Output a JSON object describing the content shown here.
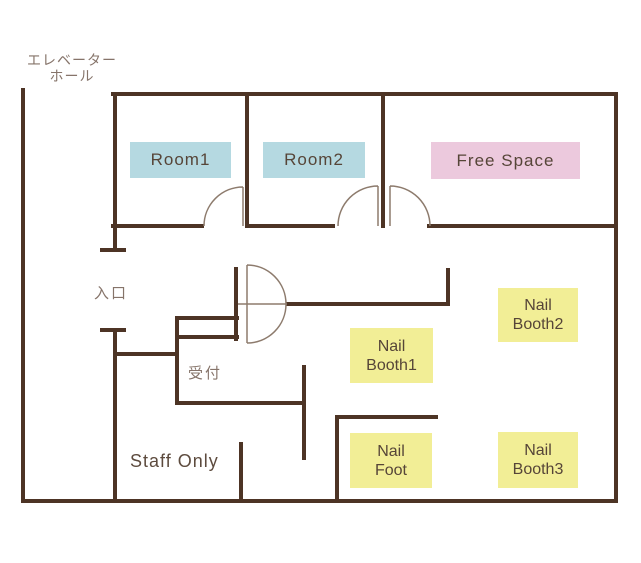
{
  "colors": {
    "wall": "#4d3425",
    "door_line": "#8d7b6d",
    "room_fill": "#b5d9e1",
    "free_space_fill": "#ecc9dd",
    "booth_fill": "#f2ee96",
    "jp_label_text": "#86746a",
    "box_text": "#564538",
    "dark_label_text": "#5d4b3e",
    "background": "#ffffff"
  },
  "plan": {
    "elevator_hall_line1": "エレベーター",
    "elevator_hall_line2": "ホール",
    "entrance": "入口",
    "reception": "受付",
    "staff_only": "Staff Only"
  },
  "rooms": {
    "room1": {
      "label": "Room1"
    },
    "room2": {
      "label": "Room2"
    },
    "free_space": {
      "label": "Free Space"
    },
    "nail_booth1": {
      "line1": "Nail",
      "line2": "Booth1"
    },
    "nail_booth2": {
      "line1": "Nail",
      "line2": "Booth2"
    },
    "nail_foot": {
      "line1": "Nail",
      "line2": "Foot"
    },
    "nail_booth3": {
      "line1": "Nail",
      "line2": "Booth3"
    }
  }
}
